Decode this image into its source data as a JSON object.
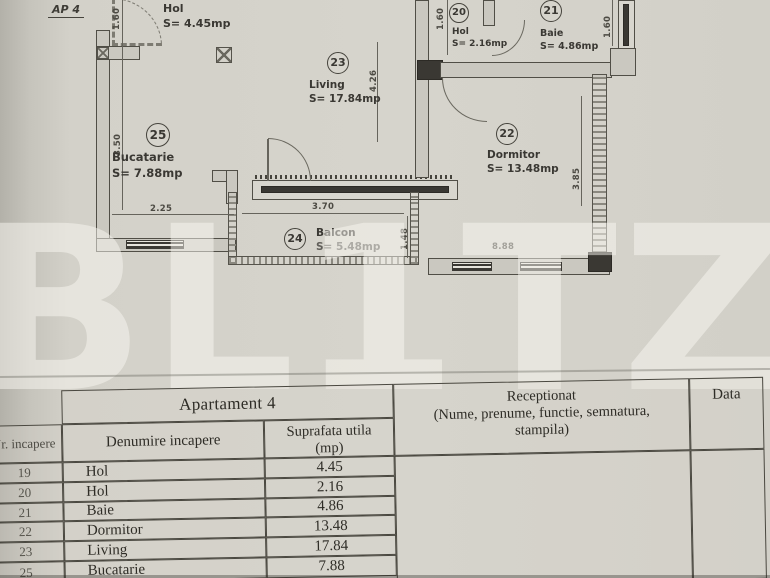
{
  "plan": {
    "ap_label": "AP 4",
    "rooms": {
      "hol19": {
        "name": "Hol",
        "area": "S= 4.45mp"
      },
      "hol20": {
        "num": "20",
        "name": "Hol",
        "area": "S= 2.16mp"
      },
      "baie21": {
        "num": "21",
        "name": "Baie",
        "area": "S= 4.86mp"
      },
      "dormitor22": {
        "num": "22",
        "name": "Dormitor",
        "area": "S= 13.48mp"
      },
      "living23": {
        "num": "23",
        "name": "Living",
        "area": "S= 17.84mp"
      },
      "balcon24": {
        "num": "24",
        "name": "Balcon",
        "area": "S= 5.48mp"
      },
      "bucatarie25": {
        "num": "25",
        "name": "Bucatarie",
        "area": "S= 7.88mp"
      }
    },
    "dimensions": {
      "top_left": "1.60",
      "bucatarie_h": "3.50",
      "bucatarie_w": "2.25",
      "balcon_w": "3.70",
      "balcon_h": "1.48",
      "living_h": "4.26",
      "hol20_h": "1.60",
      "right_window": "1.60",
      "dormitor_h": "3.85",
      "dormitor_w": "8.88"
    }
  },
  "watermark": "BL1TZ",
  "table": {
    "title": "Apartament 4",
    "col_nr": "Nr. incapere",
    "col_denumire": "Denumire incapere",
    "col_suprafata": "Suprafata utila",
    "col_suprafata_unit": "(mp)",
    "receptionat_line1": "Receptionat",
    "receptionat_line2": "(Nume, prenume, functie,   semnatura,",
    "receptionat_line3": "stampila)",
    "col_data": "Data",
    "rows": [
      {
        "nr": "19",
        "den": "Hol",
        "sup": "4.45"
      },
      {
        "nr": "20",
        "den": "Hol",
        "sup": "2.16"
      },
      {
        "nr": "21",
        "den": "Baie",
        "sup": "4.86"
      },
      {
        "nr": "22",
        "den": "Dormitor",
        "sup": "13.48"
      },
      {
        "nr": "23",
        "den": "Living",
        "sup": "17.84"
      },
      {
        "nr": "25",
        "den": "Bucatarie",
        "sup": "7.88"
      }
    ]
  }
}
